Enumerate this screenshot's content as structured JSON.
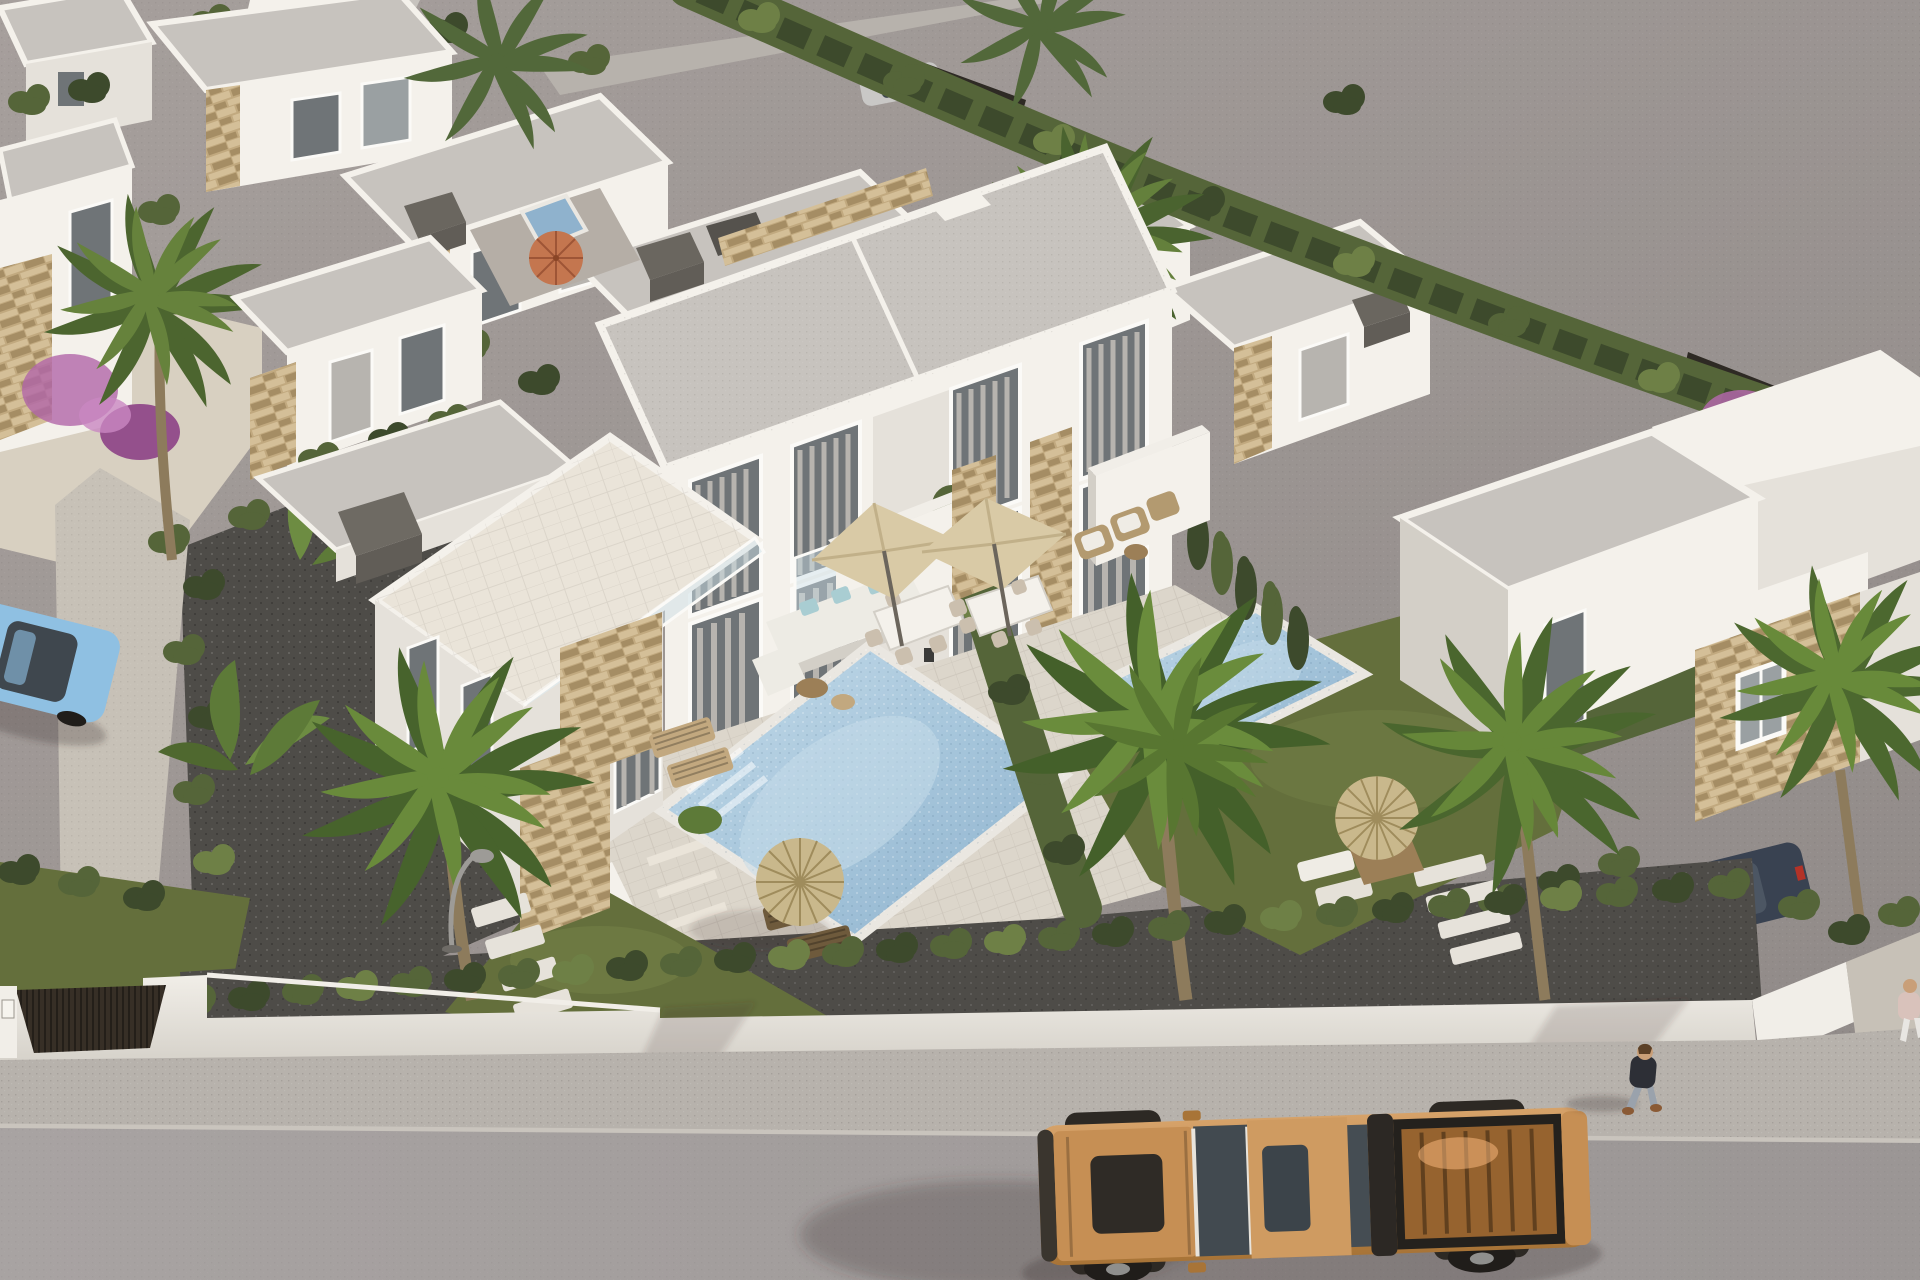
{
  "meta": {
    "description": "Aerial 3D architectural rendering of a modern white villa residential development with private pools, gardens, palm trees and a street in the foreground",
    "style": "photorealistic CGI render",
    "view": "high-angle aerial",
    "no_visible_text": true
  },
  "scene": {
    "zones": [
      "empty gray lot top-right",
      "villa cluster top-left",
      "main two-story duplex villa center",
      "two private pools with lawns",
      "right villa with stone facade",
      "white perimeter wall with hedge",
      "sidewalk and asphalt street bottom",
      "back lane behind top hedge"
    ],
    "buildings": {
      "main_duplex": 1,
      "background_villas": 9,
      "style": "flat-roof modern white with beige stone accent panels, gray gravel roofs, dark chimney blocks"
    },
    "pools": [
      {
        "location": "center garden left unit",
        "shape": "rectangular",
        "color": "light mosaic blue"
      },
      {
        "location": "right unit garden, partly behind palm",
        "shape": "rectangular",
        "color": "light mosaic blue"
      },
      {
        "location": "small plunge pool top-left patio",
        "color": "gray blue"
      }
    ],
    "vehicles": [
      {
        "type": "pickup-truck",
        "color": "tan orange, open bed",
        "location": "street bottom right"
      },
      {
        "type": "sedan",
        "color": "light blue",
        "location": "left driveway, cut by left edge"
      },
      {
        "type": "suv",
        "color": "dark blue",
        "location": "behind right hedge near wall end"
      },
      {
        "type": "hatchback",
        "color": "silver",
        "location": "back lane top center"
      },
      {
        "type": "car",
        "color": "maroon",
        "location": "behind upper-right hedge"
      }
    ],
    "people": [
      {
        "description": "pedestrian, dark jacket, light jeans, walking on sidewalk right of truck"
      },
      {
        "description": "partial second figure at extreme right edge of sidewalk"
      }
    ],
    "furniture": [
      "white L-sofa with teal cushions",
      "two beige square cantilever umbrellas over dining sets",
      "rattan armchairs by privacy wall",
      "two wooden sun loungers with straw parasol",
      "straw parasol with picnic table in right garden",
      "orange parasol on top-left patio",
      "red-white parasol behind right hedge",
      "stepping stones",
      "street lamp with curved arm"
    ],
    "landscaping": [
      "tall cypress hedges",
      "fan palms",
      "banana plants",
      "purple bougainvillea",
      "dark gravel yards",
      "green lawns",
      "sand-toned paths"
    ]
  },
  "palette": {
    "lot-1": "#a69f9c",
    "lot-2": "#8f8987",
    "street": "#a8a3a2",
    "street-dark": "#9b9695",
    "sidewalk": "#b7b2ac",
    "curb": "#c9c4bd",
    "wall-bright": "#f1eee8",
    "wall": "#e7e4dd",
    "wall-shade": "#d6d2ca",
    "gate": "#372f26",
    "white-lit": "#f4f1eb",
    "white-mid": "#e5e1da",
    "white-shade": "#d3cfc7",
    "white-dark": "#c2beb6",
    "roof": "#c7c3be",
    "roof-dark": "#b7b3ae",
    "chimney": "#615d57",
    "chimney-light": "#777younger",
    "stone-light": "#d4bf98",
    "stone-mid": "#c1a97f",
    "stone-dark": "#a58d64",
    "glass": "#6f7477",
    "glass-light": "#9aa0a2",
    "curtain": "#b7b4af",
    "frame": "#fbfaf7",
    "hedge-dark": "#3d4a2c",
    "hedge-mid": "#556539",
    "hedge-light": "#6e8046",
    "grass": "#646f3c",
    "grass-light": "#7e8c4e",
    "gravel": "#4e4c48",
    "gravel-light": "#6a6762",
    "sand": "#d8d0c1",
    "path": "#c7c1b7",
    "water": "#a4c4da",
    "water-light": "#c6dcea",
    "water-dark": "#8fb2cd",
    "coping": "#eae7e1",
    "tile": "#dcd6cb",
    "tile-light": "#eae4d9",
    "umbrella": "#d9caa6",
    "umbrella-shade": "#c1b089",
    "straw": "#c9b88c",
    "straw-dark": "#9f8c5c",
    "wood": "#9c7f57",
    "wood-light": "#c2a87f",
    "sofa": "#edebe4",
    "cushion": "#a9cdd2",
    "rattan": "#b39a70",
    "truck": "#c68f54",
    "truck-dark": "#a87437",
    "truck-trim": "#2d2924",
    "truck-glass": "#434b51",
    "bed": "#8a5e32",
    "wheel": "#201d1a",
    "hub": "#8f8f8d",
    "car-blue": "#8fc0e2",
    "car-glass": "#3f474e",
    "suv": "#394251",
    "silver-car": "#c9c8c6",
    "maroon-car": "#5c3032",
    "lamp": "#9d9b97",
    "purple": "#b267a9",
    "trunk-col": "#8d7b5c",
    "skin": "#c99f78",
    "person-top": "#2d2f36",
    "person-jeans": "#9aa2ac",
    "shoe": "#8a5a35",
    "red-parasol": "#c7473c",
    "parasol-white": "#ece7df",
    "shadow": "rgba(55,48,42,0.28)",
    "shadow-soft": "rgba(55,48,42,0.16)"
  }
}
